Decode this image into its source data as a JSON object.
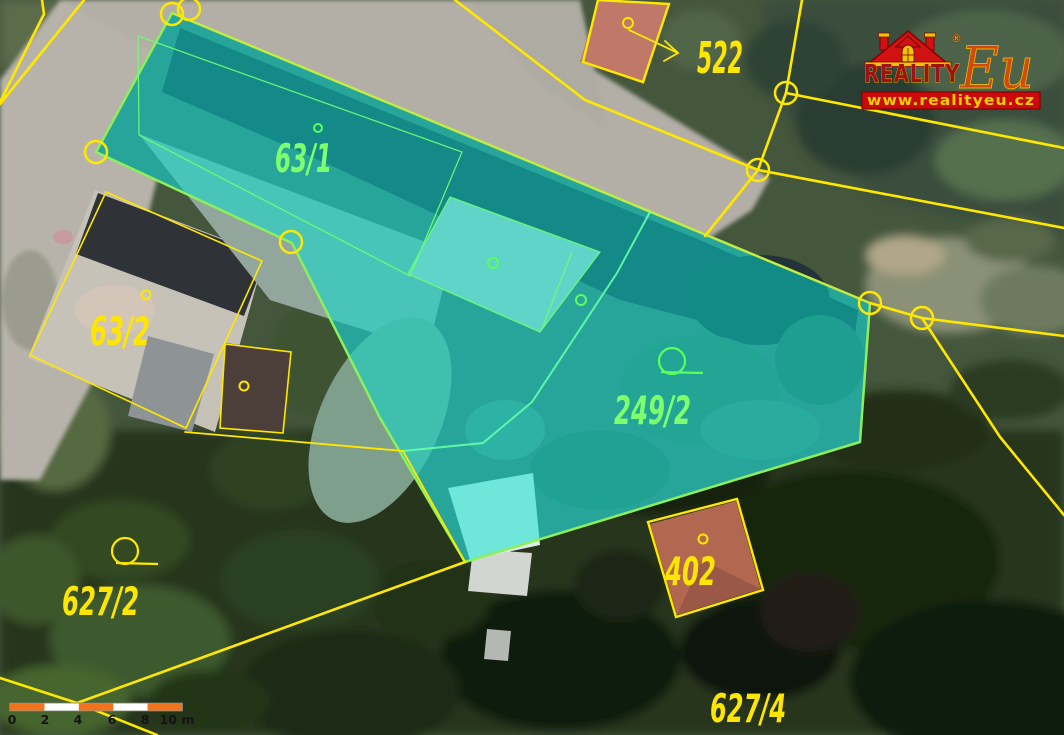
{
  "branding": {
    "company": "REALITY",
    "company_suffix": "Eu",
    "registered_mark": "®",
    "website": "www.realityeu.cz"
  },
  "map": {
    "colors": {
      "cadastral_line": "#ffe800",
      "highlight_fill": "#00e2d1",
      "highlight_edge": "#8df05a",
      "label_yellow": "#ffe600",
      "label_green": "#7dff6e",
      "scale_orange": "#f2731d",
      "logo_red": "#cc0a0a",
      "logo_yellow": "#f0c400"
    },
    "parcel_labels": {
      "p522": "522",
      "p63_1": "63/1",
      "p63_2": "63/2",
      "p249_2": "249/2",
      "p402": "402",
      "p627_2": "627/2",
      "p627_4": "627/4"
    }
  },
  "scale_bar": {
    "ticks": [
      "0",
      "2",
      "4",
      "6",
      "8",
      "10 m"
    ]
  }
}
